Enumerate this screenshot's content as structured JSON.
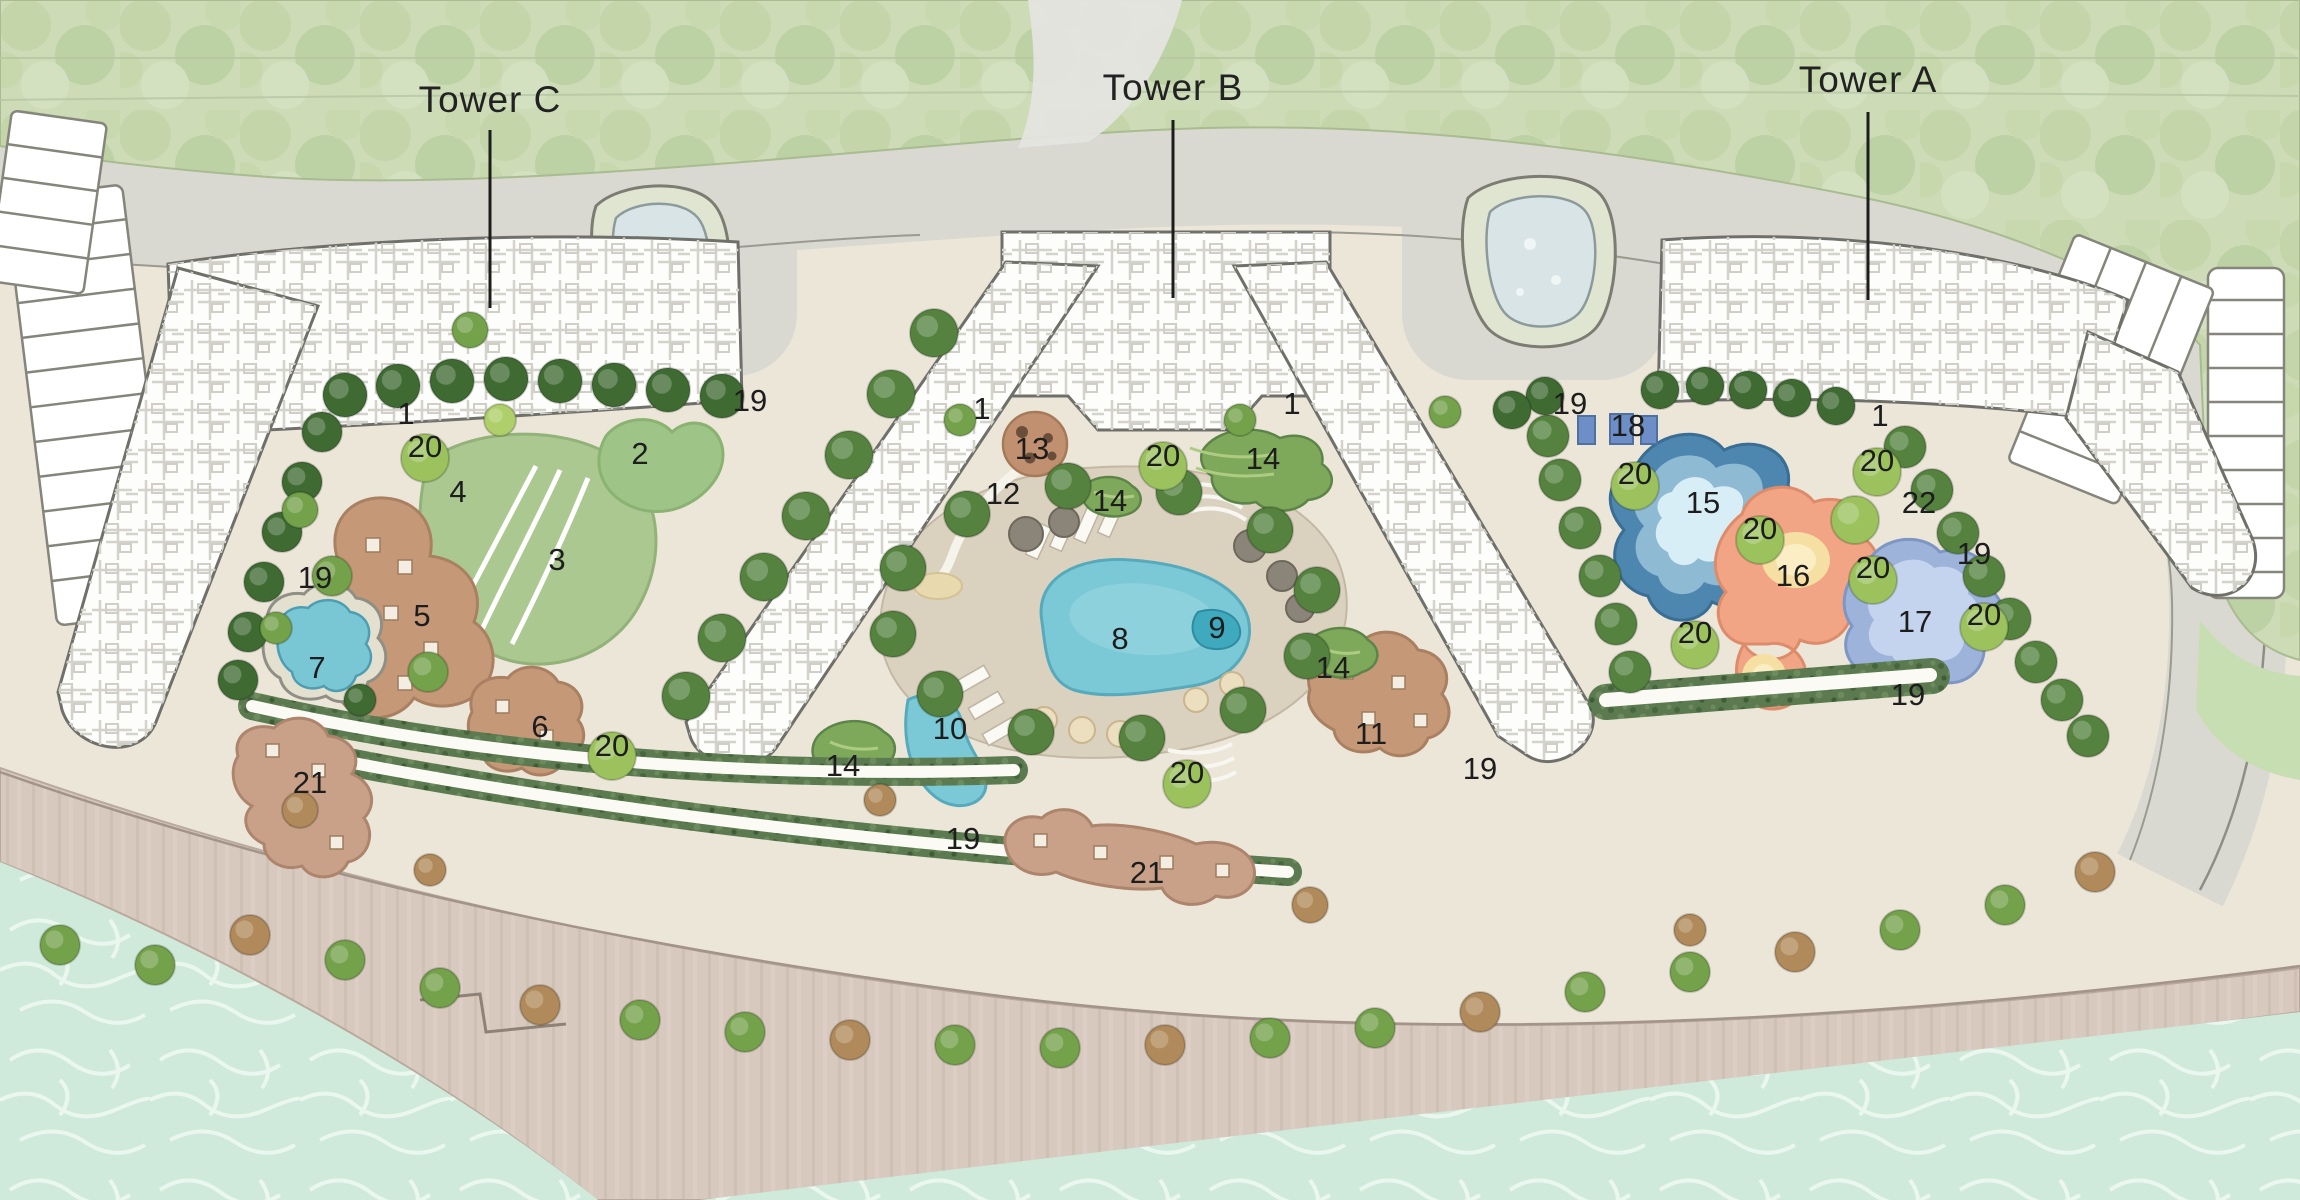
{
  "plan": {
    "towers": [
      {
        "id": "tower-c",
        "label": "Tower C",
        "x": 490,
        "y": 112,
        "line": {
          "x1": 490,
          "y1": 130,
          "x2": 490,
          "y2": 308
        }
      },
      {
        "id": "tower-b",
        "label": "Tower B",
        "x": 1173,
        "y": 100,
        "line": {
          "x1": 1173,
          "y1": 120,
          "x2": 1173,
          "y2": 298
        }
      },
      {
        "id": "tower-a",
        "label": "Tower A",
        "x": 1868,
        "y": 92,
        "line": {
          "x1": 1868,
          "y1": 112,
          "x2": 1868,
          "y2": 300
        }
      }
    ],
    "markers": [
      {
        "n": "1",
        "x": 406,
        "y": 413
      },
      {
        "n": "1",
        "x": 982,
        "y": 408
      },
      {
        "n": "1",
        "x": 1292,
        "y": 403
      },
      {
        "n": "1",
        "x": 1880,
        "y": 415
      },
      {
        "n": "2",
        "x": 640,
        "y": 453
      },
      {
        "n": "3",
        "x": 557,
        "y": 559
      },
      {
        "n": "4",
        "x": 458,
        "y": 491
      },
      {
        "n": "5",
        "x": 422,
        "y": 615
      },
      {
        "n": "6",
        "x": 540,
        "y": 726
      },
      {
        "n": "7",
        "x": 317,
        "y": 667
      },
      {
        "n": "8",
        "x": 1120,
        "y": 638
      },
      {
        "n": "9",
        "x": 1217,
        "y": 627
      },
      {
        "n": "10",
        "x": 950,
        "y": 728
      },
      {
        "n": "11",
        "x": 1371,
        "y": 733
      },
      {
        "n": "12",
        "x": 1003,
        "y": 493
      },
      {
        "n": "13",
        "x": 1032,
        "y": 448
      },
      {
        "n": "14",
        "x": 1110,
        "y": 500
      },
      {
        "n": "14",
        "x": 1263,
        "y": 458
      },
      {
        "n": "14",
        "x": 1333,
        "y": 667
      },
      {
        "n": "14",
        "x": 843,
        "y": 765
      },
      {
        "n": "15",
        "x": 1703,
        "y": 502
      },
      {
        "n": "16",
        "x": 1793,
        "y": 575
      },
      {
        "n": "17",
        "x": 1915,
        "y": 621
      },
      {
        "n": "18",
        "x": 1628,
        "y": 425
      },
      {
        "n": "19",
        "x": 315,
        "y": 577
      },
      {
        "n": "19",
        "x": 750,
        "y": 400
      },
      {
        "n": "19",
        "x": 963,
        "y": 838
      },
      {
        "n": "19",
        "x": 1480,
        "y": 768
      },
      {
        "n": "19",
        "x": 1570,
        "y": 403
      },
      {
        "n": "19",
        "x": 1974,
        "y": 553
      },
      {
        "n": "19",
        "x": 1908,
        "y": 694
      },
      {
        "n": "20",
        "x": 425,
        "y": 446
      },
      {
        "n": "20",
        "x": 612,
        "y": 745
      },
      {
        "n": "20",
        "x": 1163,
        "y": 455
      },
      {
        "n": "20",
        "x": 1187,
        "y": 772
      },
      {
        "n": "20",
        "x": 1635,
        "y": 473
      },
      {
        "n": "20",
        "x": 1760,
        "y": 528
      },
      {
        "n": "20",
        "x": 1873,
        "y": 567
      },
      {
        "n": "20",
        "x": 1877,
        "y": 460
      },
      {
        "n": "20",
        "x": 1695,
        "y": 632
      },
      {
        "n": "20",
        "x": 1984,
        "y": 614
      },
      {
        "n": "21",
        "x": 310,
        "y": 782
      },
      {
        "n": "21",
        "x": 1147,
        "y": 872
      },
      {
        "n": "22",
        "x": 1919,
        "y": 502
      }
    ],
    "colors": {
      "forest": "#cddcb6",
      "ground": "#ece6d9",
      "road": "#d9d9d2",
      "sand": "#d7c9be",
      "water": "#cfe9da",
      "lawn": "#aac88f",
      "deck_wood": "#c59878",
      "pool_turquoise": "#7bc9d6",
      "pool_deep_blue": "#4d86ae",
      "pool_coral": "#f2a585",
      "pool_periwinkle": "#9db3da",
      "hedge": "#4f7340",
      "building": "#fdfdfb",
      "lap_lane_blue": "#6d8ec6",
      "track_core": "#fbfaf5"
    }
  }
}
